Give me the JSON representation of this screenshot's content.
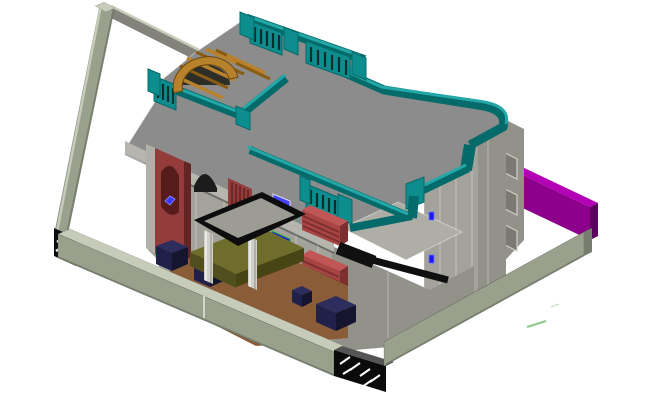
{
  "view": {
    "type": "isometric-3d-cad-model",
    "subject": "two-storey residential bungalow with compound wall, roof parapets and entrance gate",
    "background": "#ffffff"
  },
  "colors": {
    "background": "#ffffff",
    "compound_wall_face": "#99a08c",
    "compound_wall_top": "#c7cbb9",
    "compound_wall_dark": "#767d6c",
    "back_wall": "#83837b",
    "gate_black": "#0b0b0b",
    "gate_hatch": "#ffffff",
    "purple_wall": "#8c008c",
    "purple_wall_top": "#b400b4",
    "purple_wall_dark": "#5a005e",
    "roof": "#8c8c8c",
    "roof_eave": "#b6b6ae",
    "slab_light": "#aeaea6",
    "parapet_teal_dark": "#046a6a",
    "parapet_teal": "#0d8d8d",
    "parapet_teal_top": "#23a7a7",
    "parapet_slot": "#0a2e2e",
    "facade": "#a3a39b",
    "facade_shade": "#92928a",
    "facade_dark": "#7a7a72",
    "maroon_panel": "#943c3c",
    "maroon_dark": "#632424",
    "louver_red": "#a84444",
    "louver_red_top": "#c05656",
    "louver_red_dark": "#7c2f2f",
    "pergola_orange": "#b8812c",
    "pergola_orange_dark": "#8a5c12",
    "canopy_black": "#0d0d0d",
    "canopy_top": "#9c9c94",
    "column_gray": "#d0d0c8",
    "magenta_door": "#e020d0",
    "window_blue": "#1a1aee",
    "window_frame_green": "#2fae2f",
    "steps_navy": "#20204a",
    "steps_navy_top": "#2e2e5e",
    "platform_olive": "#6f6d2c",
    "platform_olive_dark": "#514f1e",
    "floor_brown": "#8a5c38",
    "balcony_black": "#101010",
    "marker_green": "#8bc98b"
  },
  "elements": [
    "boundary-wall",
    "hatched-gate-pillar",
    "entrance-gate",
    "purple-side-wall",
    "main-roof",
    "roof-parapet",
    "parapet-railing",
    "stair-pergola",
    "mumty-terrace",
    "corner-tower",
    "arch-panel",
    "louver-sunshade",
    "window",
    "porch-canopy",
    "porch-column",
    "porch-platform",
    "entrance-grille-door",
    "floor-terrace",
    "step-block",
    "balcony-band",
    "survey-marker"
  ]
}
